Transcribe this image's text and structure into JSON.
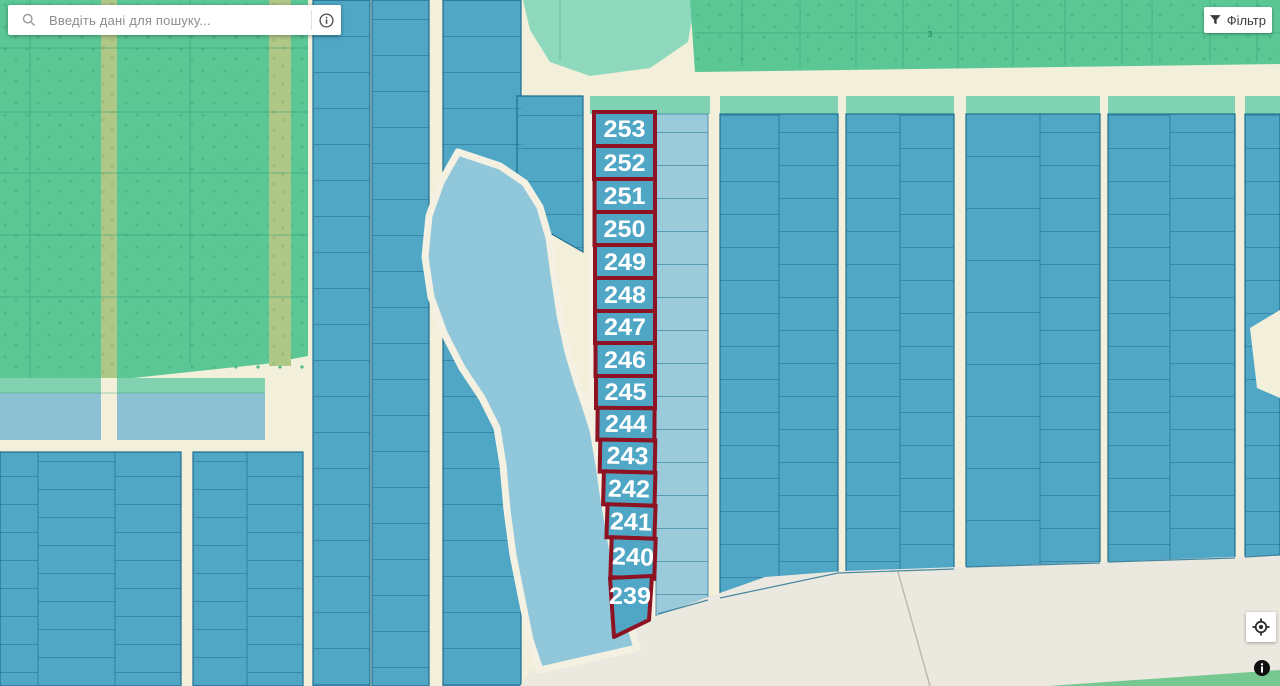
{
  "search_bar": {
    "placeholder": "Введіть дані для пошуку...",
    "magnifier_icon": "magnifier-icon",
    "details_icon": "info-circle-outline-icon"
  },
  "filter_button": {
    "label": "Фільтр",
    "icon": "funnel-filter-icon"
  },
  "map": {
    "highlighted_parcels": [
      {
        "label": "253"
      },
      {
        "label": "252"
      },
      {
        "label": "251"
      },
      {
        "label": "250"
      },
      {
        "label": "249"
      },
      {
        "label": "248"
      },
      {
        "label": "247"
      },
      {
        "label": "246"
      },
      {
        "label": "245"
      },
      {
        "label": "244"
      },
      {
        "label": "243"
      },
      {
        "label": "242"
      },
      {
        "label": "241"
      },
      {
        "label": "240"
      },
      {
        "label": "239"
      }
    ],
    "tiny_parcel_label": "3",
    "colors": {
      "parcel_blue": "#4fa6c5",
      "parcel_border": "#1f6e90",
      "light_parcel_blue": "#9bcadb",
      "water": "#90c7da",
      "shore_cream": "#f4f1e2",
      "road_cream": "#f2efda",
      "open_area": "#ebe9df",
      "green_field": "#5bc795",
      "olive_strip": "#afc888",
      "teal_strip": "#80d3b2",
      "teal_curve": "#8ed9bd",
      "light_blue_band": "#8dc0d2",
      "highlight_border": "#8d1322",
      "label_text": "#ffffff"
    }
  },
  "controls": {
    "locate_icon": "crosshair-target-icon",
    "attribution_icon": "info-filled-icon"
  }
}
